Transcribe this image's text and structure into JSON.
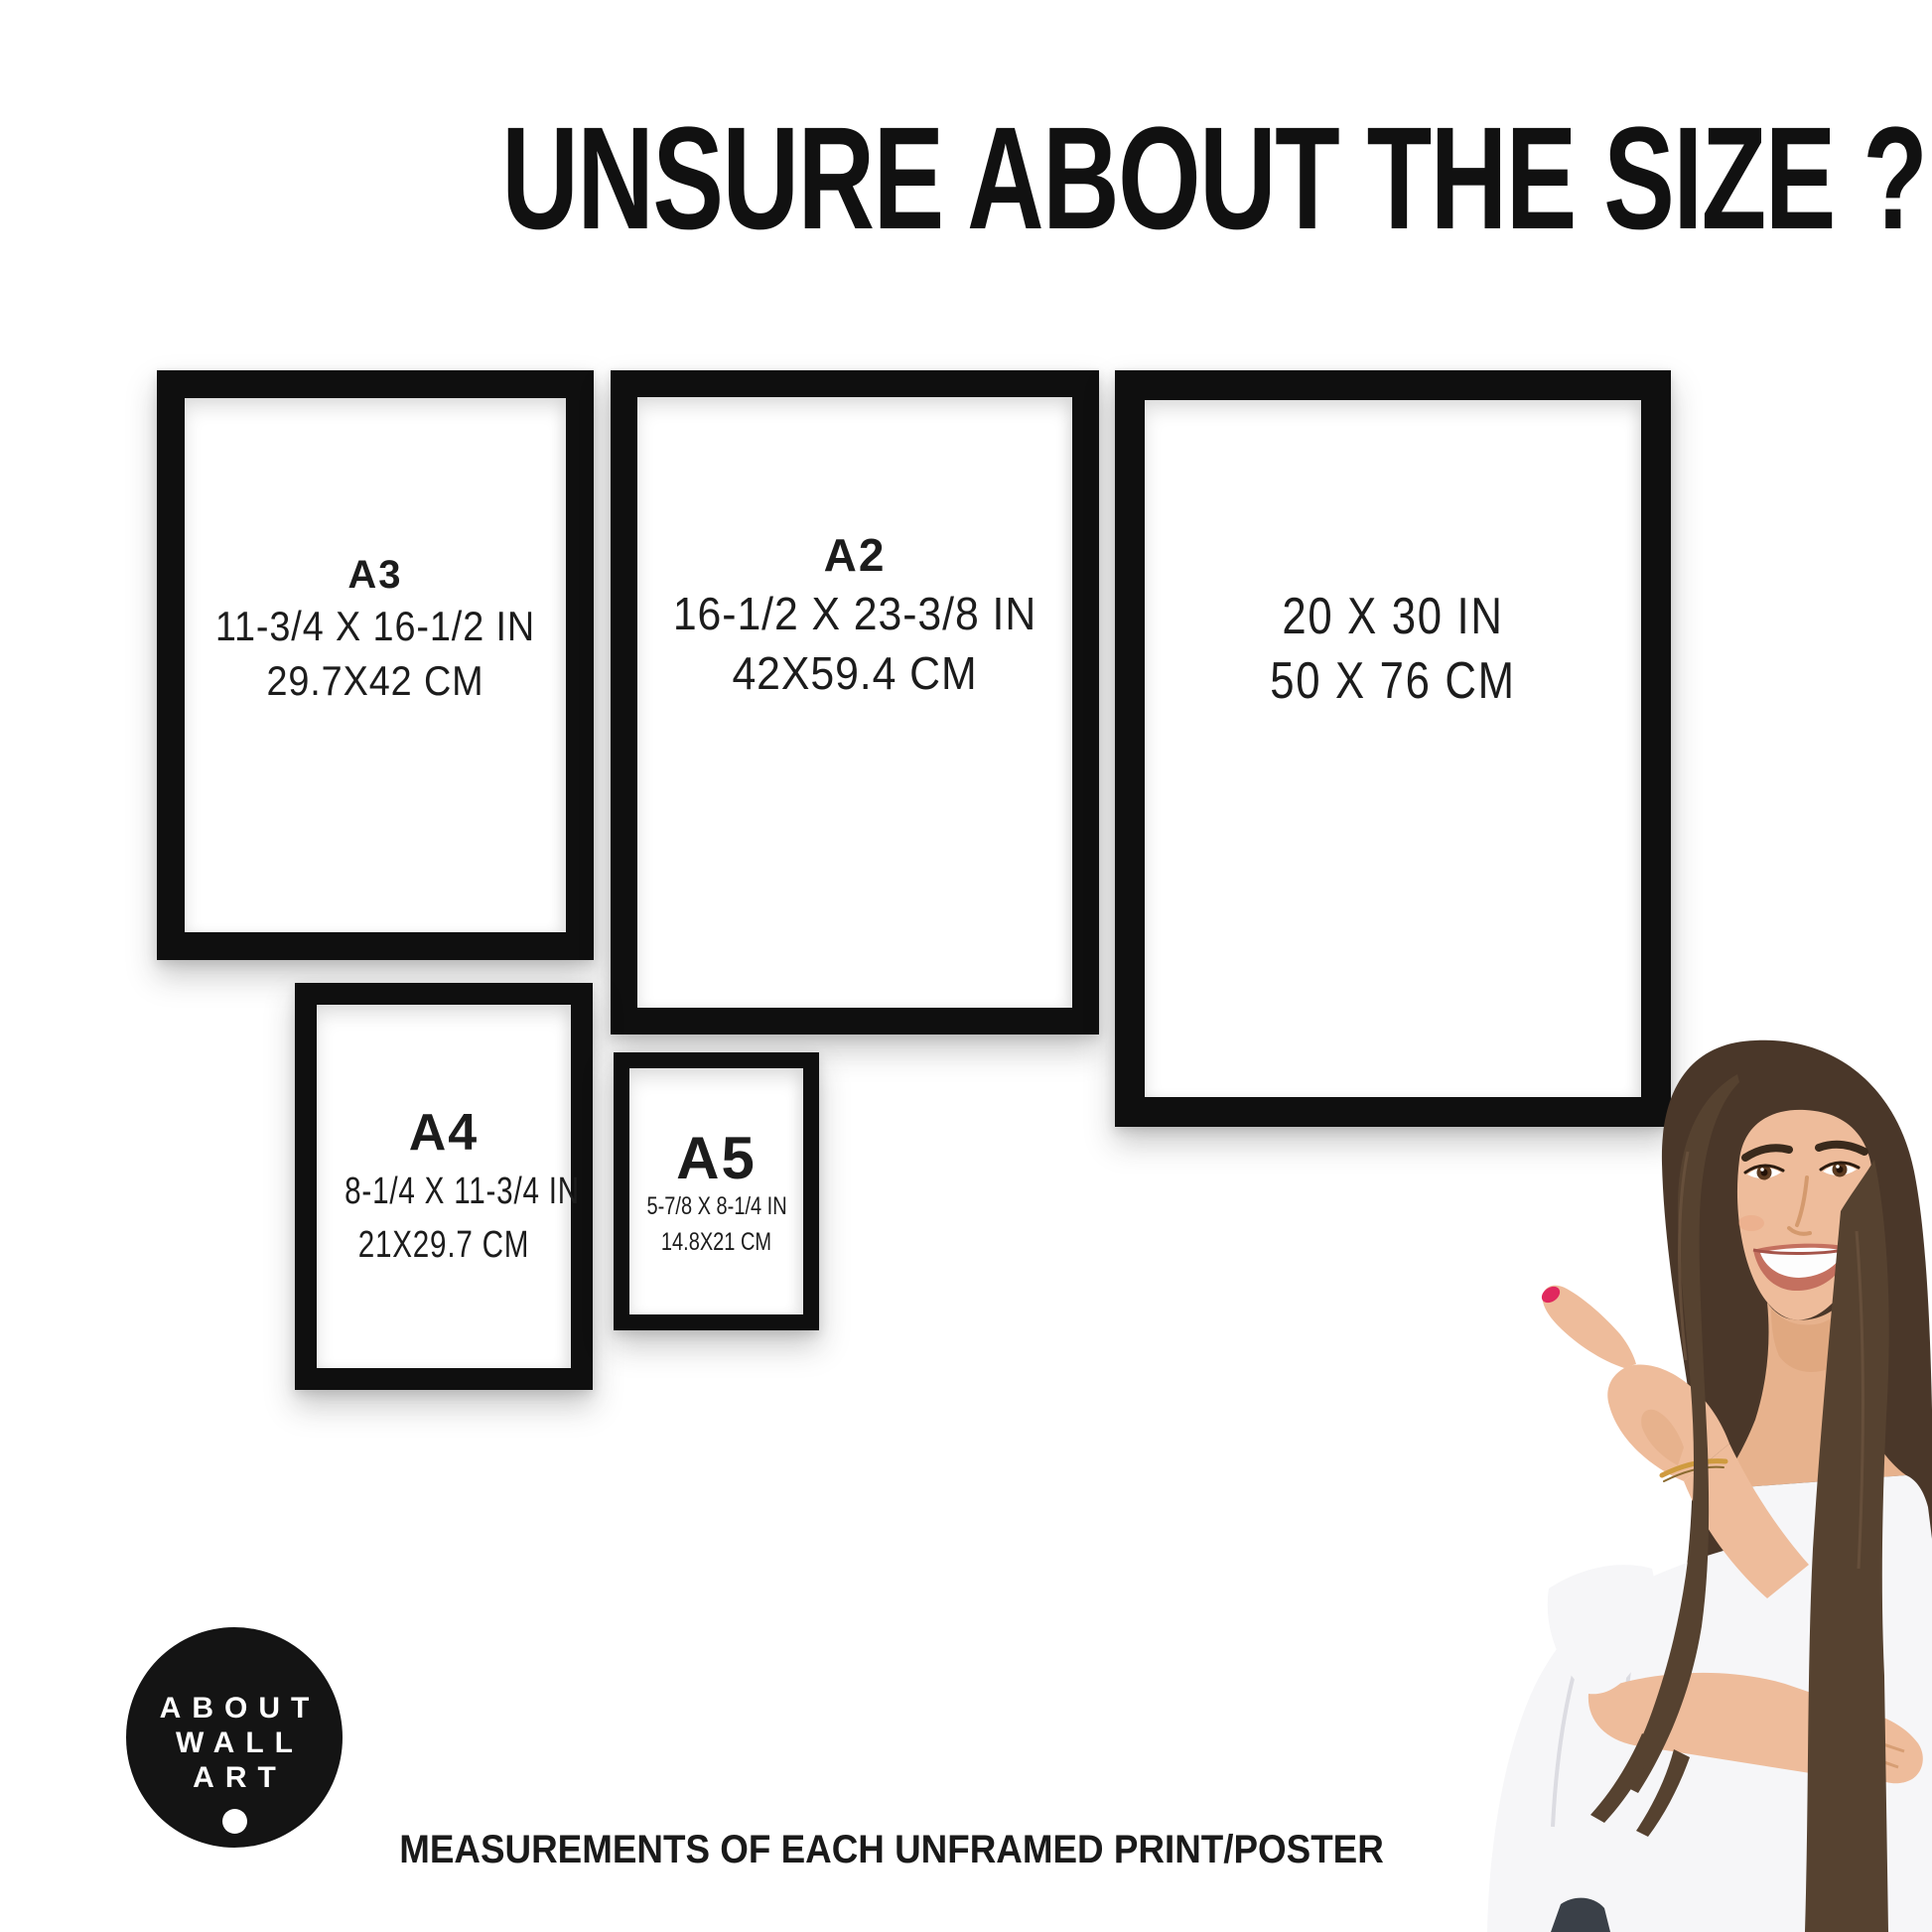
{
  "page": {
    "title": "UNSURE ABOUT THE SIZE ?",
    "footer": "MEASUREMENTS OF EACH UNFRAMED PRINT/POSTER",
    "background_color": "#ffffff",
    "frame_color": "#0f0f0f",
    "text_color": "#1c1c1c"
  },
  "frames": [
    {
      "label": "A3",
      "inches": "11-3/4 X 16-1/2 IN",
      "cm": "29.7X42 CM"
    },
    {
      "label": "A2",
      "inches": "16-1/2 X 23-3/8 IN",
      "cm": "42X59.4 CM"
    },
    {
      "label": "",
      "inches": "20 X 30 IN",
      "cm": "50 X 76 CM"
    },
    {
      "label": "A4",
      "inches": "8-1/4 X 11-3/4 IN",
      "cm": "21X29.7 CM"
    },
    {
      "label": "A5",
      "inches": "5-7/8 X 8-1/4 IN",
      "cm": "14.8X21 CM"
    }
  ],
  "logo": {
    "lines": [
      "ABOUT",
      "WALL",
      "ART"
    ],
    "background_color": "#141414",
    "text_color": "#ffffff"
  },
  "photo": {
    "alt": "smiling woman with long brown hair pointing at the frames",
    "hair_color": "#4a3729",
    "skin_color": "#eebc9b",
    "top_color": "#f6f6f8",
    "nail_color": "#e0285e",
    "jeans_color": "#3a4048"
  }
}
